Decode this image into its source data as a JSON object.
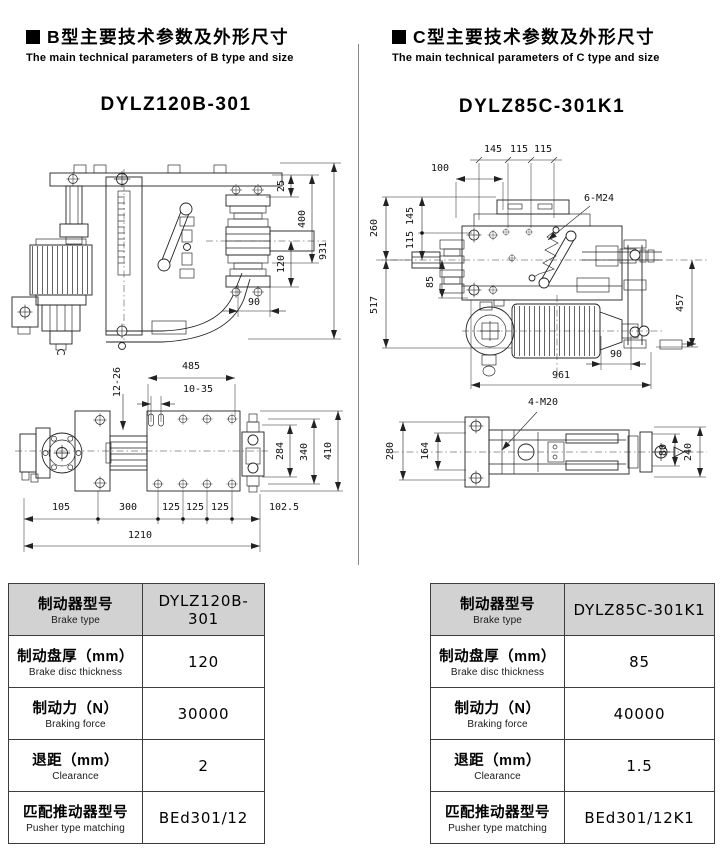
{
  "sections": [
    {
      "heading_cn": "B型主要技术参数及外形尺寸",
      "heading_en": "The main technical parameters of B type and size",
      "model": "DYLZ120B-301",
      "table": {
        "rows": [
          {
            "cn": "制动器型号",
            "en": "Brake type",
            "value": "DYLZ120B-301"
          },
          {
            "cn": "制动盘厚（mm）",
            "en": "Brake disc thickness",
            "value": "120"
          },
          {
            "cn": "制动力（N）",
            "en": "Braking force",
            "value": "30000"
          },
          {
            "cn": "退距（mm）",
            "en": "Clearance",
            "value": "2"
          },
          {
            "cn": "匹配推动器型号",
            "en": "Pusher type matching",
            "value": "BEd301/12"
          }
        ]
      }
    },
    {
      "heading_cn": "C型主要技术参数及外形尺寸",
      "heading_en": "The main technical parameters of C type and size",
      "model": "DYLZ85C-301K1",
      "table": {
        "rows": [
          {
            "cn": "制动器型号",
            "en": "Brake type",
            "value": "DYLZ85C-301K1"
          },
          {
            "cn": "制动盘厚（mm）",
            "en": "Brake disc thickness",
            "value": "85"
          },
          {
            "cn": "制动力（N）",
            "en": "Braking force",
            "value": "40000"
          },
          {
            "cn": "退距（mm）",
            "en": "Clearance",
            "value": "1.5"
          },
          {
            "cn": "匹配推动器型号",
            "en": "Pusher type matching",
            "value": "BEd301/12K1"
          }
        ]
      }
    }
  ],
  "drawings": {
    "b_front": {
      "d25": "25",
      "d400": "400",
      "d931": "931",
      "d120": "120",
      "d90": "90"
    },
    "b_plan": {
      "d485": "485",
      "slot_a": "12-26",
      "slot_b": "10-35",
      "d284": "284",
      "d340": "340",
      "d410": "410",
      "d105": "105",
      "d300": "300",
      "d125a": "125",
      "d125b": "125",
      "d125c": "125",
      "d102": "102.5",
      "d1210": "1210"
    },
    "c_front": {
      "d145": "145",
      "d115a": "115",
      "d115b": "115",
      "d100": "100",
      "bolt": "6-M24",
      "d260": "260",
      "d115_145": "115 145",
      "d517": "517",
      "d85": "85",
      "d457": "457",
      "d90": "90",
      "d961": "961"
    },
    "c_plan": {
      "bolt": "4-M20",
      "d280": "280",
      "d164": "164",
      "d80": "80",
      "d240": "240"
    }
  }
}
